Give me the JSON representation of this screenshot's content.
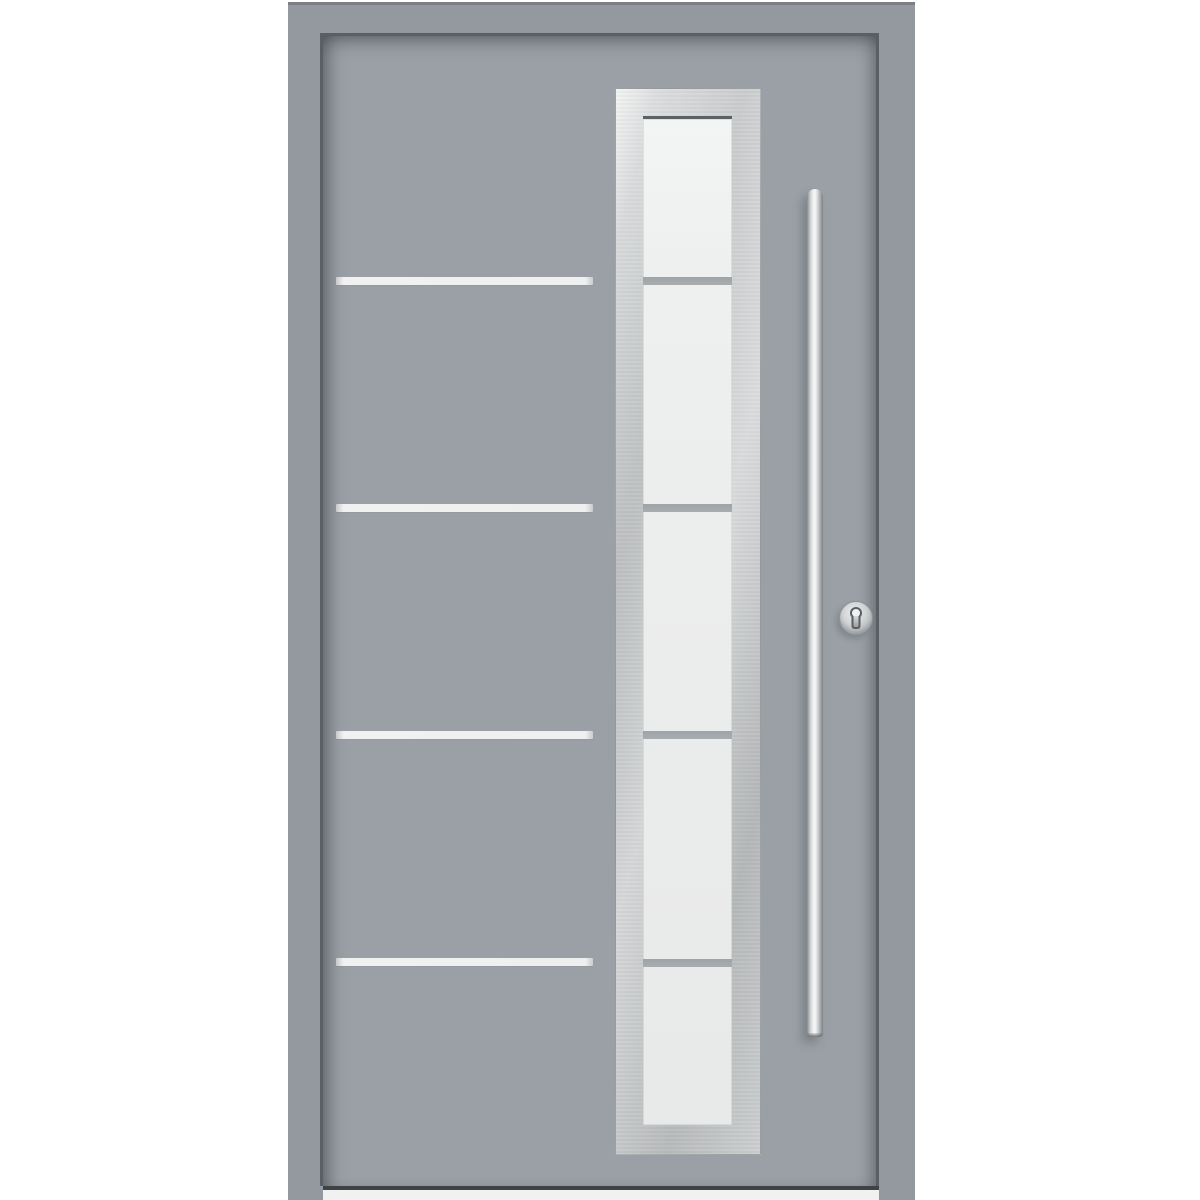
{
  "image_type": "product-photo",
  "subject": "Modern light-gray aluminum front entry door with a full-height frosted glass panel in a brushed stainless steel frame, four horizontal inox stripes, a long stainless steel bar handle and a profile cylinder lock",
  "colors": {
    "background": "#ffffff",
    "frame": "#94999f",
    "door_leaf": "#9aa0a6",
    "stripe": "#eff0f0",
    "steel_panel": "#c8cbcc",
    "glass": "#ededee",
    "glass_divider": "#a2a7ab",
    "handle_highlight": "#f5f6f6",
    "handle_shade": "#878c91",
    "reveal_shadow": "#5a5f64",
    "threshold": "#f1f1f1"
  },
  "scene": {
    "canvas": {
      "width": 1200,
      "height": 1200
    },
    "frame": {
      "x": 288,
      "y": 2,
      "width": 627,
      "height": 1198
    },
    "leaf": {
      "x": 320,
      "y": 33,
      "width": 559,
      "height": 1153
    },
    "stripes": {
      "x": 336,
      "width": 257,
      "height": 8,
      "count": 4,
      "y_positions": [
        277,
        504,
        731,
        958
      ]
    },
    "glazing": {
      "panel": {
        "x": 615,
        "y": 88,
        "width": 146,
        "height": 1067
      },
      "glass": {
        "x": 643,
        "y": 116,
        "width": 89,
        "height": 1009
      },
      "dividers": {
        "height": 8,
        "count": 4,
        "y_positions": [
          277,
          504,
          731,
          959
        ]
      },
      "sections": 5
    },
    "handle": {
      "x": 807,
      "y": 189,
      "width": 16,
      "height": 848
    },
    "lock": {
      "cx": 856,
      "cy": 618,
      "radius": 17
    },
    "threshold": {
      "x": 323,
      "y": 1186,
      "width": 556,
      "height": 14
    }
  }
}
